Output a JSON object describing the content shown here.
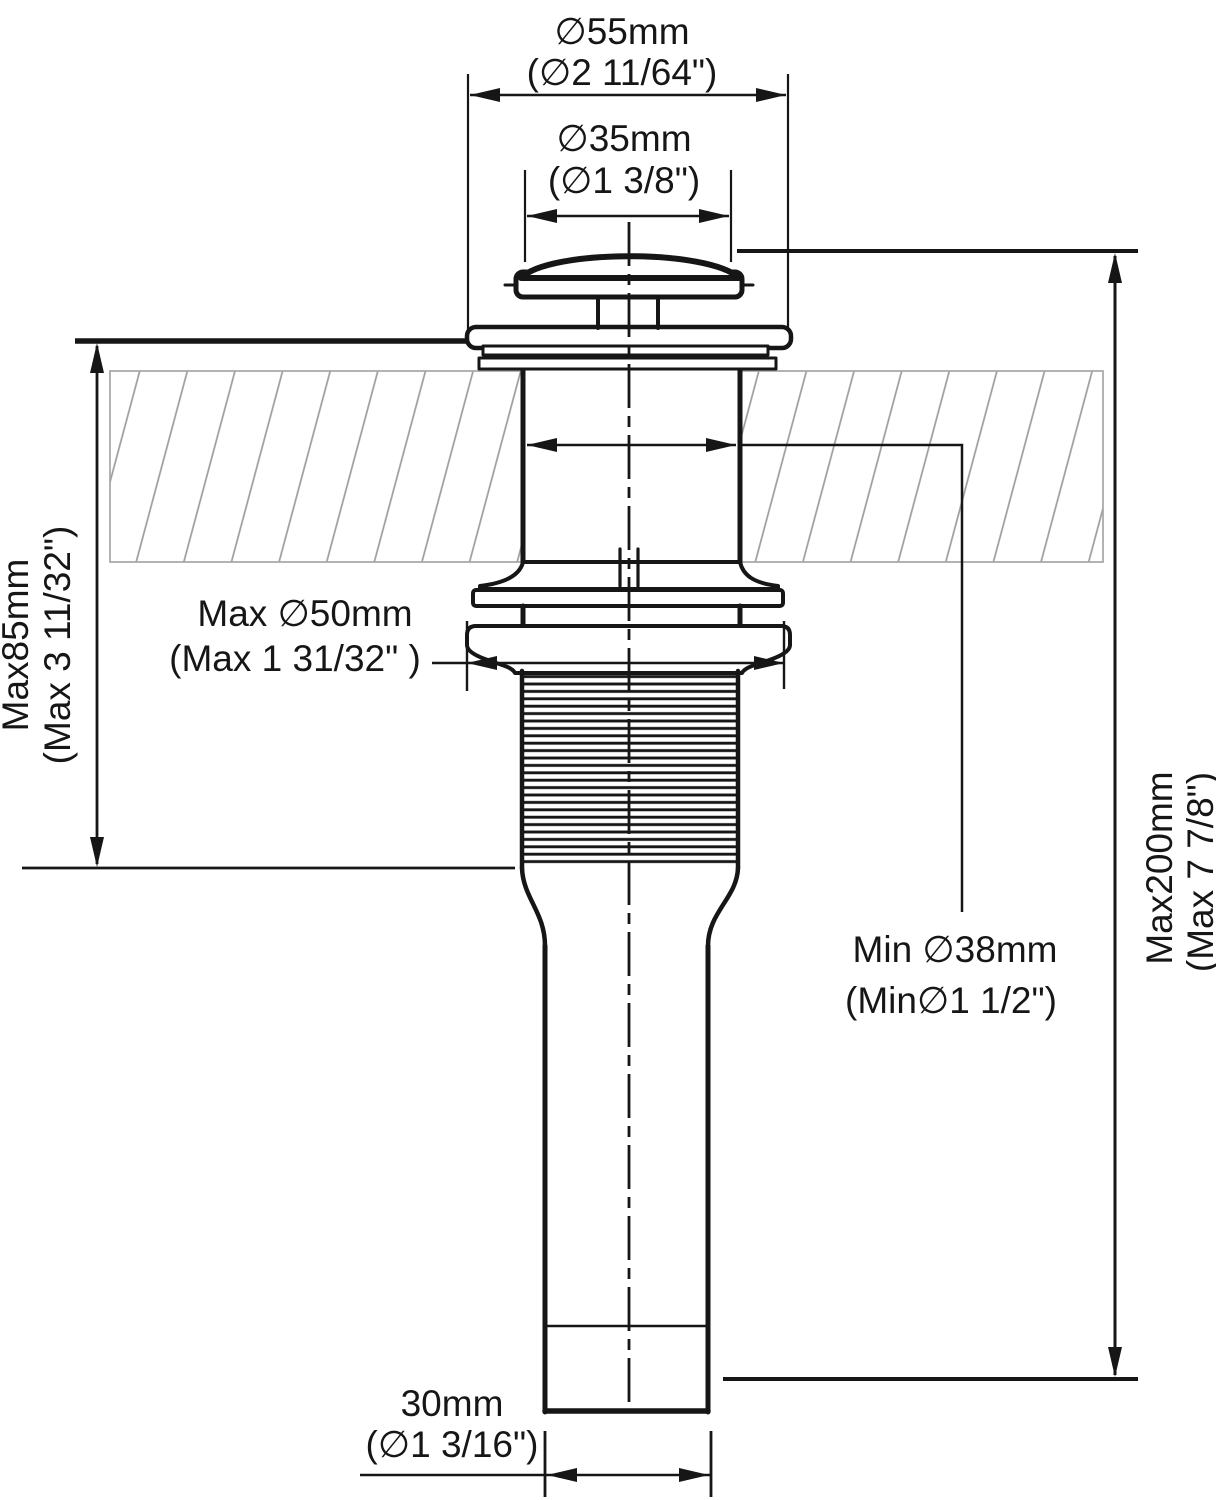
{
  "drawing": {
    "title": "Pop-up sink drain installation dimension diagram",
    "colors": {
      "line": "#161616",
      "hatch": "#9c9c9c",
      "background": "#ffffff"
    },
    "dimensions": {
      "cap_diameter": {
        "metric": "∅55mm",
        "imperial": "(∅2 11/64\")"
      },
      "top_opening_diameter": {
        "metric": "∅35mm",
        "imperial": "(∅1 3/8\")"
      },
      "max_deck_thickness": {
        "metric": "Max85mm",
        "imperial": "(Max 3 11/32\")"
      },
      "max_hole_diameter": {
        "metric": "Max ∅50mm",
        "imperial": "(Max 1 31/32\" )"
      },
      "min_hole_diameter": {
        "metric": "Min ∅38mm",
        "imperial": "(Min∅1 1/2\")"
      },
      "max_total_height": {
        "metric": "Max200mm",
        "imperial": "(Max 7 7/8\")"
      },
      "tailpiece_diameter": {
        "metric": "30mm",
        "imperial": "(∅1 3/16\")"
      }
    }
  }
}
